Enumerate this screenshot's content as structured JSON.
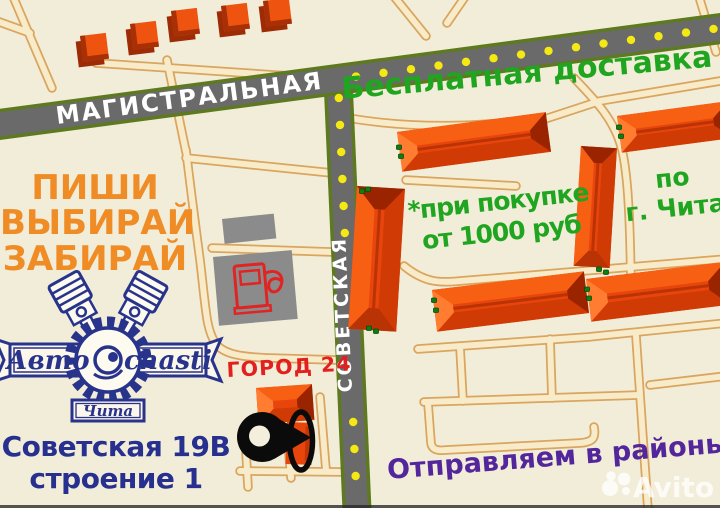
{
  "roads": {
    "magistralnaya": "МАГИСТРАЛЬНАЯ",
    "sovetskaya": "СОВЕТСКАЯ"
  },
  "promo": {
    "free_delivery": "Бесплатная доставка",
    "condition_line1": "*при покупке",
    "condition_line2": "от 1000 руб",
    "region_line1": "по",
    "region_line2": "г. Чита",
    "shipping": "Отправляем в районы"
  },
  "slogan": {
    "line1": "ПИШИ",
    "line2": "ВЫБИРАЙ",
    "line3": "ЗАБИРАЙ"
  },
  "logo": {
    "name_left": "Авто",
    "name_right": "chasti",
    "city": "Чита"
  },
  "store": {
    "name": "ГОРОД 24",
    "address_line1": "Советская 19В",
    "address_line2": "строение 1"
  },
  "watermark": {
    "brand": "Avito"
  },
  "colors": {
    "background": "#f2edd9",
    "road_main": "#6a6a6a",
    "road_edge_green": "#5e7a20",
    "road_minor_fill": "#f8ebc9",
    "road_minor_edge": "#d9a55f",
    "dashes_yellow": "#f4e913",
    "building_orange": "#e8450c",
    "building_dark": "#9b2400",
    "gray_building": "#8b8b8b",
    "green_text": "#1fa51f",
    "orange_text": "#ef8c25",
    "logo_navy": "#28338c",
    "blue_text": "#27308e",
    "red_text": "#e3201e",
    "purple_text": "#53279b"
  }
}
